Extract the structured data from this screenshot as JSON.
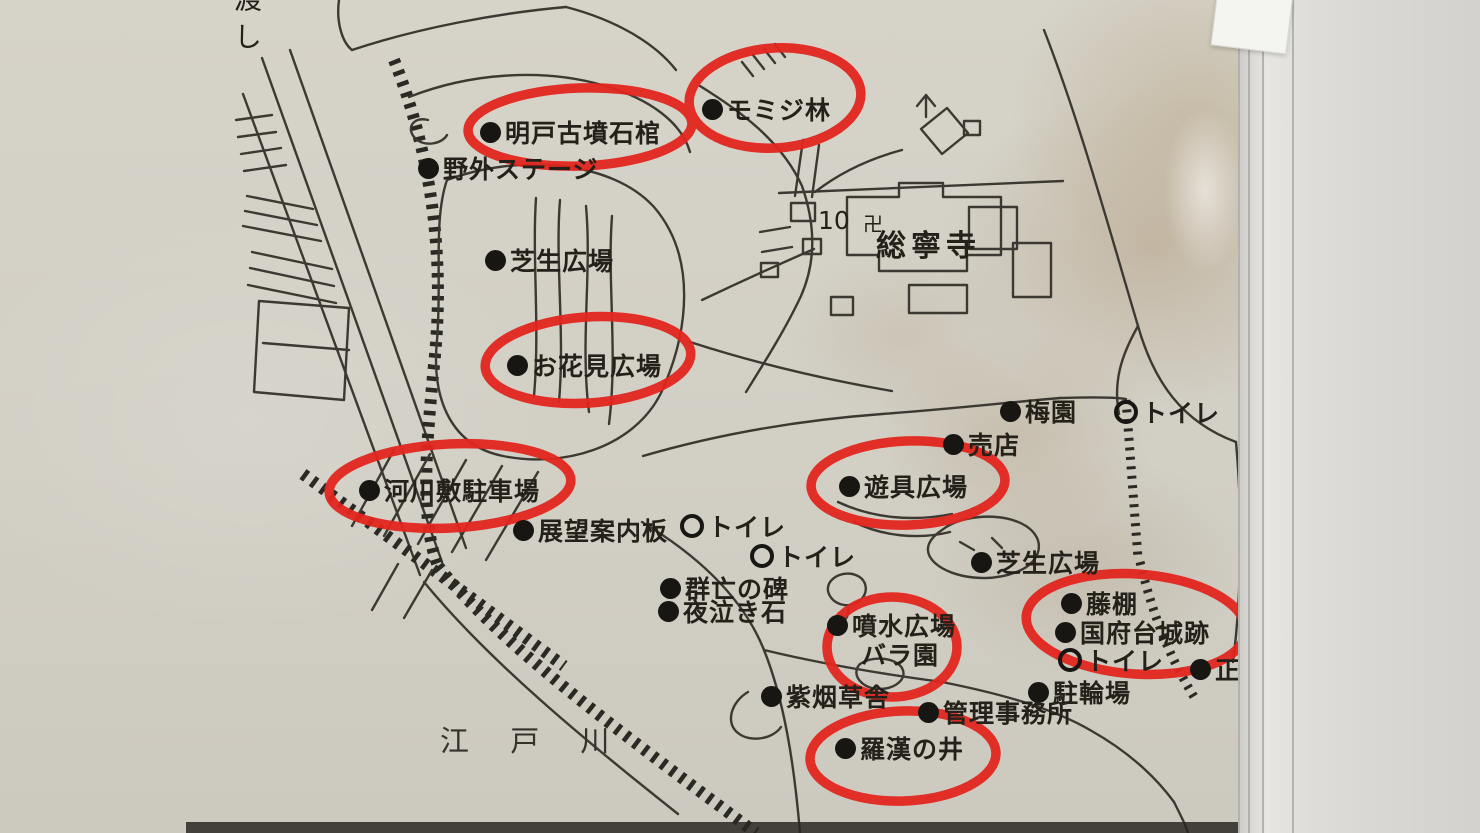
{
  "photo_description": "printed park guide map in plastic sleeve with red circled highlights",
  "colors": {
    "paper": "#d3d0c6",
    "ink": "#3b3932",
    "text": "#232119",
    "highlight_red": "#e2251e",
    "sleeve": "#deddd9"
  },
  "map": {
    "labels": [
      {
        "id": "ferry",
        "text": "渡し",
        "cls": "vertical",
        "x": 226,
        "y": -16
      },
      {
        "id": "akedo-kofun-sekkan",
        "text": "明戸古墳石棺",
        "marker": "dot",
        "x": 480,
        "y": 114,
        "circled": true
      },
      {
        "id": "momiji-grove",
        "text": "モミジ林",
        "marker": "dot",
        "x": 702,
        "y": 91,
        "circled": true
      },
      {
        "id": "yagai-stage",
        "text": "野外ステージ",
        "marker": "dot",
        "x": 418,
        "y": 150
      },
      {
        "id": "shibafu-hiroba-1",
        "text": "芝生広場",
        "marker": "dot",
        "x": 485,
        "y": 242
      },
      {
        "id": "plot-number",
        "text": "10",
        "cls": "number",
        "x": 818,
        "y": 206
      },
      {
        "id": "temple-symbol",
        "text": "卍",
        "cls": "symbol",
        "x": 863,
        "y": 208
      },
      {
        "id": "sonei-ji",
        "text": "総寧寺",
        "cls": "temple",
        "x": 876,
        "y": 221
      },
      {
        "id": "ohanami-hiroba",
        "text": "お花見広場",
        "marker": "dot",
        "x": 507,
        "y": 347,
        "circled": true
      },
      {
        "id": "umeen",
        "text": "梅園",
        "marker": "dot",
        "x": 1000,
        "y": 393
      },
      {
        "id": "toilet-1",
        "text": "トイレ",
        "marker": "ring",
        "x": 1114,
        "y": 394
      },
      {
        "id": "baiten",
        "text": "売店",
        "marker": "dot",
        "x": 943,
        "y": 426
      },
      {
        "id": "kasenjiki-parking",
        "text": "河川敷駐車場",
        "marker": "dot",
        "x": 359,
        "y": 472,
        "circled": true
      },
      {
        "id": "tenbo-annaiban",
        "text": "展望案内板",
        "marker": "dot",
        "x": 513,
        "y": 512
      },
      {
        "id": "toilet-2",
        "text": "トイレ",
        "marker": "ring",
        "x": 680,
        "y": 508
      },
      {
        "id": "toilet-3",
        "text": "トイレ",
        "marker": "ring",
        "x": 750,
        "y": 538
      },
      {
        "id": "yugu-hiroba",
        "text": "遊具広場",
        "marker": "dot",
        "x": 839,
        "y": 468,
        "circled": true
      },
      {
        "id": "shibafu-hiroba-2",
        "text": "芝生広場",
        "marker": "dot",
        "x": 971,
        "y": 544
      },
      {
        "id": "gunbo-no-hi",
        "text": "群亡の碑",
        "marker": "dot",
        "x": 660,
        "y": 570
      },
      {
        "id": "yonaki-ishi",
        "text": "夜泣き石",
        "marker": "dot",
        "x": 658,
        "y": 593
      },
      {
        "id": "funsui-hiroba",
        "text": "噴水広場",
        "marker": "dot",
        "x": 827,
        "y": 607
      },
      {
        "id": "bara-en",
        "text": "バラ園",
        "x": 861,
        "y": 636,
        "circled": true
      },
      {
        "id": "fujidana",
        "text": "藤棚",
        "marker": "dot",
        "x": 1061,
        "y": 585,
        "circled": true
      },
      {
        "id": "konodai-joseki",
        "text": "国府台城跡",
        "marker": "dot",
        "x": 1055,
        "y": 614,
        "circled": true
      },
      {
        "id": "toilet-4",
        "text": "トイレ",
        "marker": "ring",
        "x": 1058,
        "y": 642,
        "circled": true
      },
      {
        "id": "seimon",
        "text": "正",
        "marker": "dot",
        "x": 1190,
        "y": 651
      },
      {
        "id": "churinjo",
        "text": "駐輪場",
        "marker": "dot",
        "x": 1028,
        "y": 674
      },
      {
        "id": "shien-sosha",
        "text": "紫烟草舎",
        "marker": "dot",
        "x": 761,
        "y": 678
      },
      {
        "id": "kanri-jimusho",
        "text": "管理事務所",
        "marker": "dot",
        "x": 918,
        "y": 694
      },
      {
        "id": "rakan-no-i",
        "text": "羅漢の井",
        "marker": "dot",
        "x": 835,
        "y": 730,
        "circled": true
      },
      {
        "id": "edogawa-river",
        "text": "江 戸 川",
        "cls": "river",
        "x": 440,
        "y": 718
      }
    ],
    "highlights": [
      {
        "id": "momiji",
        "target": "モミジ林",
        "cx": 775,
        "cy": 98,
        "rx": 86,
        "ry": 50,
        "rot": -4
      },
      {
        "id": "akedo",
        "target": "明戸古墳石棺",
        "cx": 580,
        "cy": 127,
        "rx": 112,
        "ry": 39,
        "rot": -2
      },
      {
        "id": "ohanami",
        "target": "お花見広場",
        "cx": 588,
        "cy": 360,
        "rx": 103,
        "ry": 43,
        "rot": -4
      },
      {
        "id": "kasen",
        "target": "河川敷駐車場",
        "cx": 450,
        "cy": 486,
        "rx": 121,
        "ry": 42,
        "rot": -3
      },
      {
        "id": "yugu",
        "target": "遊具広場",
        "cx": 908,
        "cy": 483,
        "rx": 97,
        "ry": 42,
        "rot": -2
      },
      {
        "id": "bara",
        "target": "バラ園",
        "cx": 892,
        "cy": 647,
        "rx": 65,
        "ry": 50,
        "rot": 0
      },
      {
        "id": "konodai",
        "target": "国府台城跡",
        "cx": 1136,
        "cy": 624,
        "rx": 110,
        "ry": 50,
        "rot": 4
      },
      {
        "id": "rakan",
        "target": "羅漢の井",
        "cx": 903,
        "cy": 756,
        "rx": 93,
        "ry": 45,
        "rot": -2
      }
    ]
  }
}
